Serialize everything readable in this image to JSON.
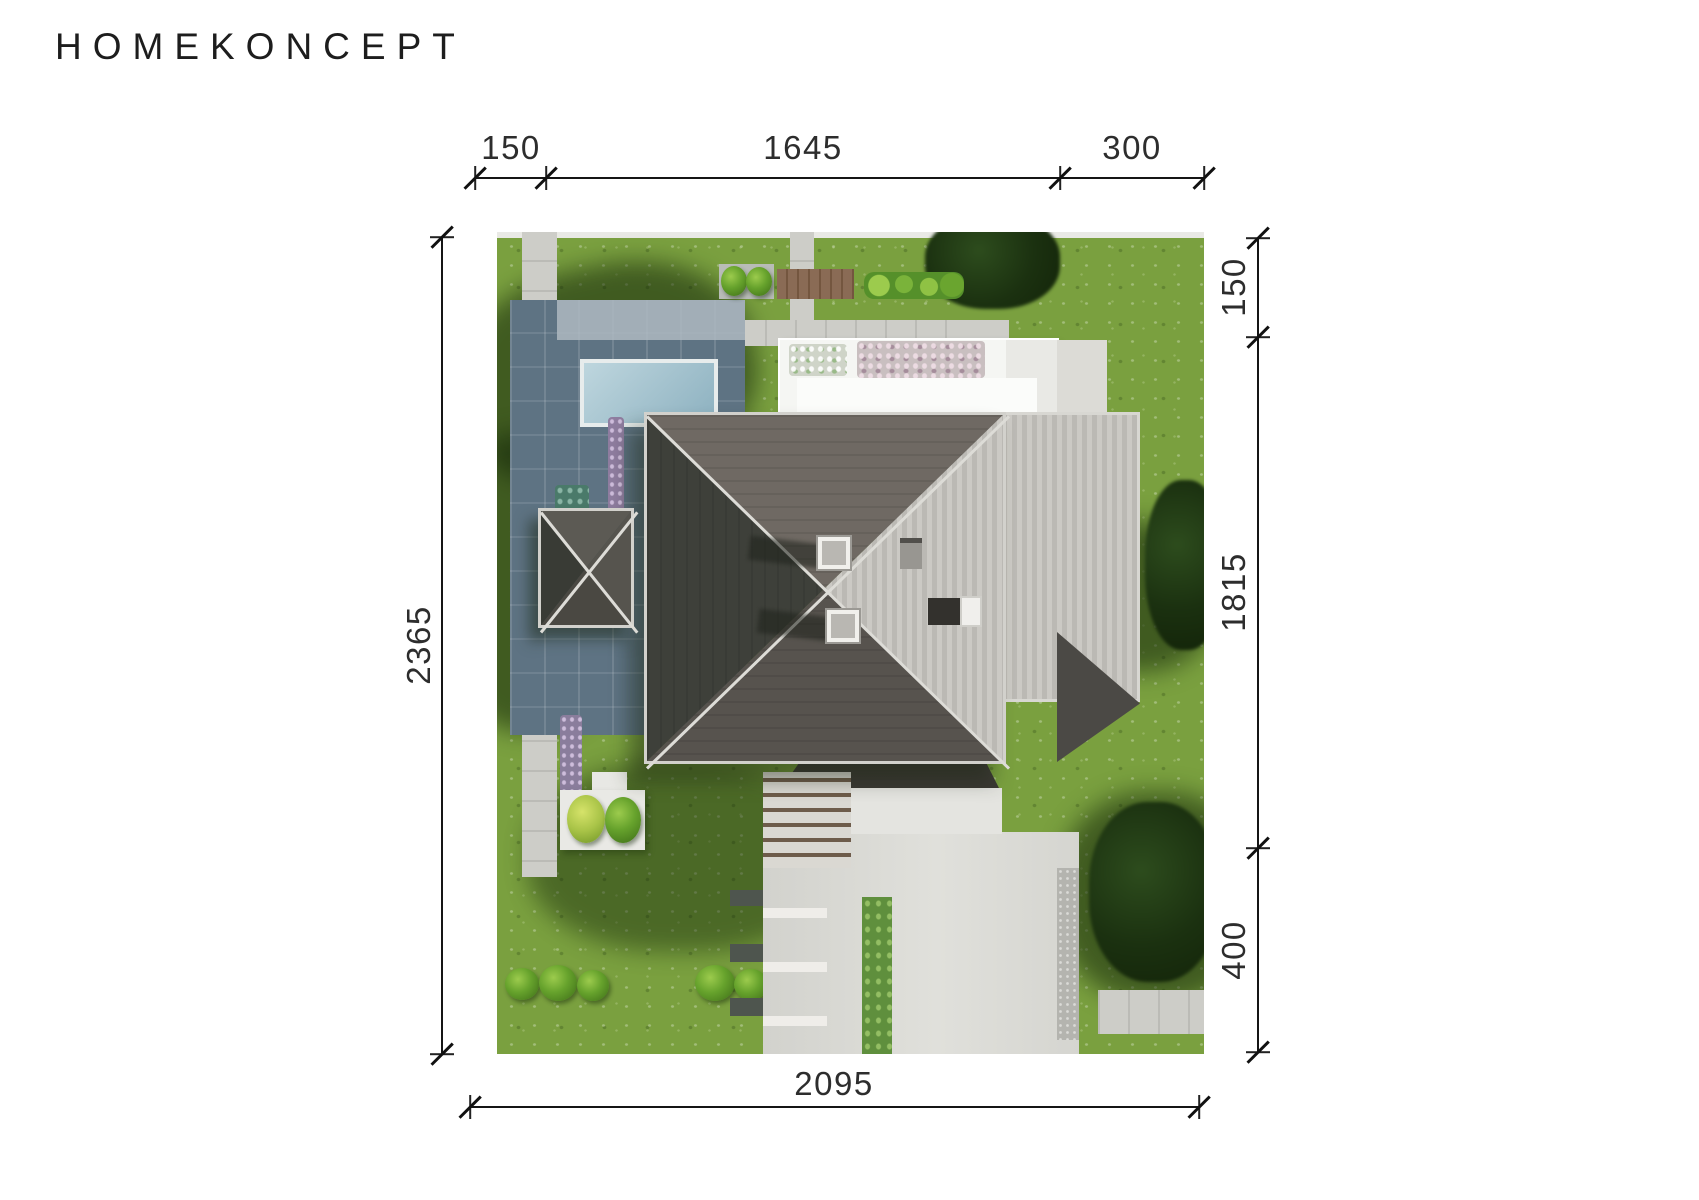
{
  "logo": {
    "text": "HOMEKONCEPT"
  },
  "dimensions": {
    "top": {
      "segments": [
        {
          "label": "150"
        },
        {
          "label": "1645"
        },
        {
          "label": "300"
        }
      ]
    },
    "right": {
      "segments": [
        {
          "label": "150"
        },
        {
          "label": "1815"
        },
        {
          "label": "400"
        }
      ]
    },
    "left": {
      "label": "2365"
    },
    "bottom": {
      "label": "2095"
    }
  },
  "palette": {
    "background": "#ffffff",
    "dimension_lines": "#151515",
    "dimension_text": "#2d2d2d",
    "grass": "#7aa03f",
    "grass_shadow": "#1b3110",
    "path": "#cdcdc8",
    "patio_shadowed": "#5e7383",
    "pool": "#a7c4d0",
    "roof_dark": "#3e403a",
    "roof_medium": "#6f6963",
    "roof_light_seam": "#c4c2bd",
    "flat_roof_white": "#f5f6f3",
    "deck_wood": "#84644d",
    "driveway": "#d8d8d3"
  }
}
